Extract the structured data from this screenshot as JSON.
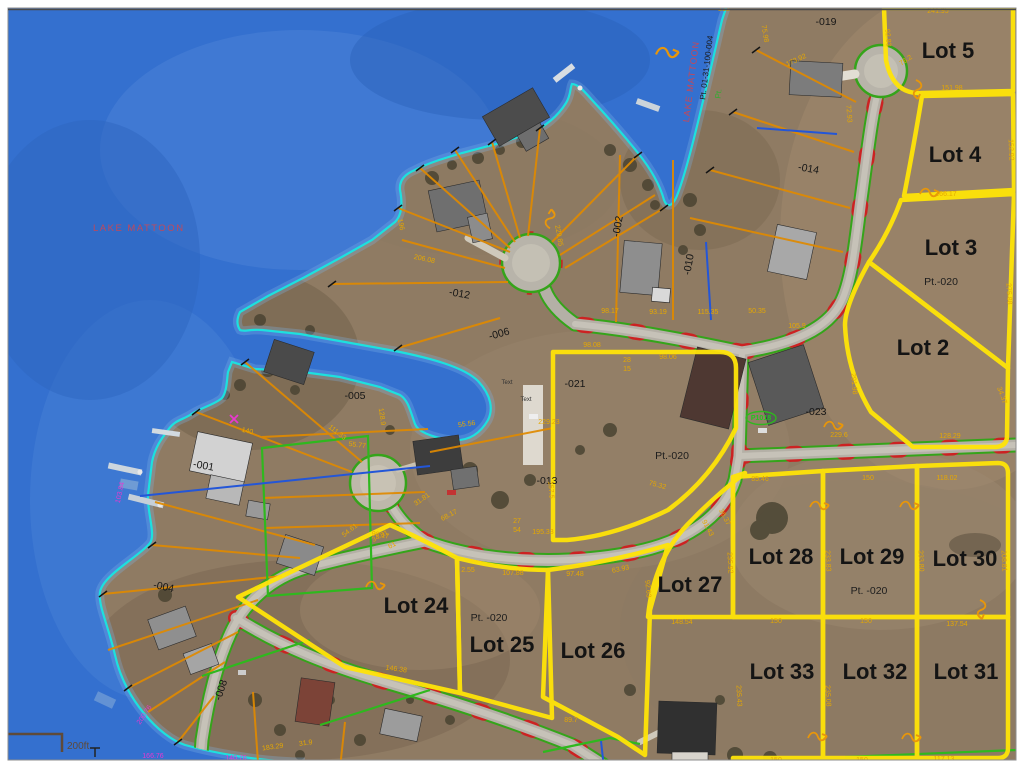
{
  "map": {
    "colors": {
      "water": "#3470cf",
      "land": "#8f7b63",
      "shoreline": "#19e5e0",
      "road_edge_green": "#35a41a",
      "road_tick_red": "#cc2222",
      "lot_line_yellow": "#ffe408",
      "parcel_line_orange": "#e08a00",
      "annotation_magenta": "#e838d0",
      "waterline_blue": "#2356d8"
    },
    "labels": {
      "lake_main": "LAKE MATTOON",
      "lake_vertical": "LAKE MATTOON",
      "plss": "Pt. 01-31-100-004",
      "shore_green": "Pt.",
      "badge": "P1018",
      "scale": "200ft",
      "tiny1": "Text",
      "tiny2": "Text"
    },
    "lots": {
      "lot5": "Lot 5",
      "lot4": "Lot 4",
      "lot3": "Lot 3",
      "lot2": "Lot 2",
      "lot24": "Lot 24",
      "lot25": "Lot 25",
      "lot26": "Lot 26",
      "lot27": "Lot 27",
      "lot28": "Lot 28",
      "lot29": "Lot 29",
      "lot30": "Lot 30",
      "lot33": "Lot 33",
      "lot32": "Lot 32",
      "lot31": "Lot 31"
    },
    "pt": {
      "a": "Pt.-020",
      "b": "Pt.-020",
      "c": "Pt. -020",
      "d": "Pt. -020"
    },
    "parcels": {
      "p019": "-019",
      "p014": "-014",
      "p002": "-002",
      "p010": "-010",
      "p012": "-012",
      "p006": "-006",
      "p005": "-005",
      "p021": "-021",
      "p013": "-013",
      "p001": "-001",
      "p004": "-004",
      "p008": "-008",
      "p023": "-023"
    },
    "dims": {
      "d01": "212",
      "d02": "241.95",
      "d03": "151.98",
      "d04": "152.92",
      "d05": "92.83",
      "d06": "76.2",
      "d07": "173.92",
      "d08": "166.17",
      "d09": "275.88",
      "d10": "291.98",
      "d11": "34.37",
      "d12": "229.6",
      "d13": "128.29",
      "d14": "150",
      "d15": "118.02",
      "d16": "85.46",
      "d17": "98.17",
      "d18": "93.19",
      "d19": "115.35",
      "d20": "50.35",
      "d21": "98.08",
      "d22": "105.9",
      "d23": "98.06",
      "d24": "148.54",
      "d25": "150",
      "d26": "150",
      "d27": "137.54",
      "d28": "150",
      "d29": "150",
      "d30": "117.13",
      "d31": "235.92",
      "d32": "233.83",
      "d33": "233.80",
      "d34": "208.81",
      "d35": "235.43",
      "d36": "235.08",
      "d37": "92.63",
      "d38": "91.43",
      "d39": "36.37",
      "d40": "75.32",
      "d41": "195.33",
      "d42": "2.55",
      "d43": "107.88",
      "d44": "97.48",
      "d45": "63.93",
      "d46": "98.17",
      "d47": "54.61",
      "d48": "89.7",
      "d49": "111.33",
      "d50": "55.77",
      "d51": "229.23",
      "d52": "157.5",
      "d53": "146.38",
      "d54": "103.84",
      "d55": "200.76",
      "d56": "166.76",
      "d57": "140.76",
      "d58": "183.29",
      "d59": "31.9",
      "d60": "206.08",
      "d61": "196",
      "d62": "229.85",
      "d63": "72.93",
      "d64": "140",
      "d65": "34.81",
      "d66": "61",
      "d67": "31.81",
      "d68": "68.17",
      "d69": "128.9",
      "d70": "55.56",
      "d71": "28",
      "d72": "15",
      "d73": "75.98",
      "d74": "27",
      "d75": "54"
    }
  }
}
